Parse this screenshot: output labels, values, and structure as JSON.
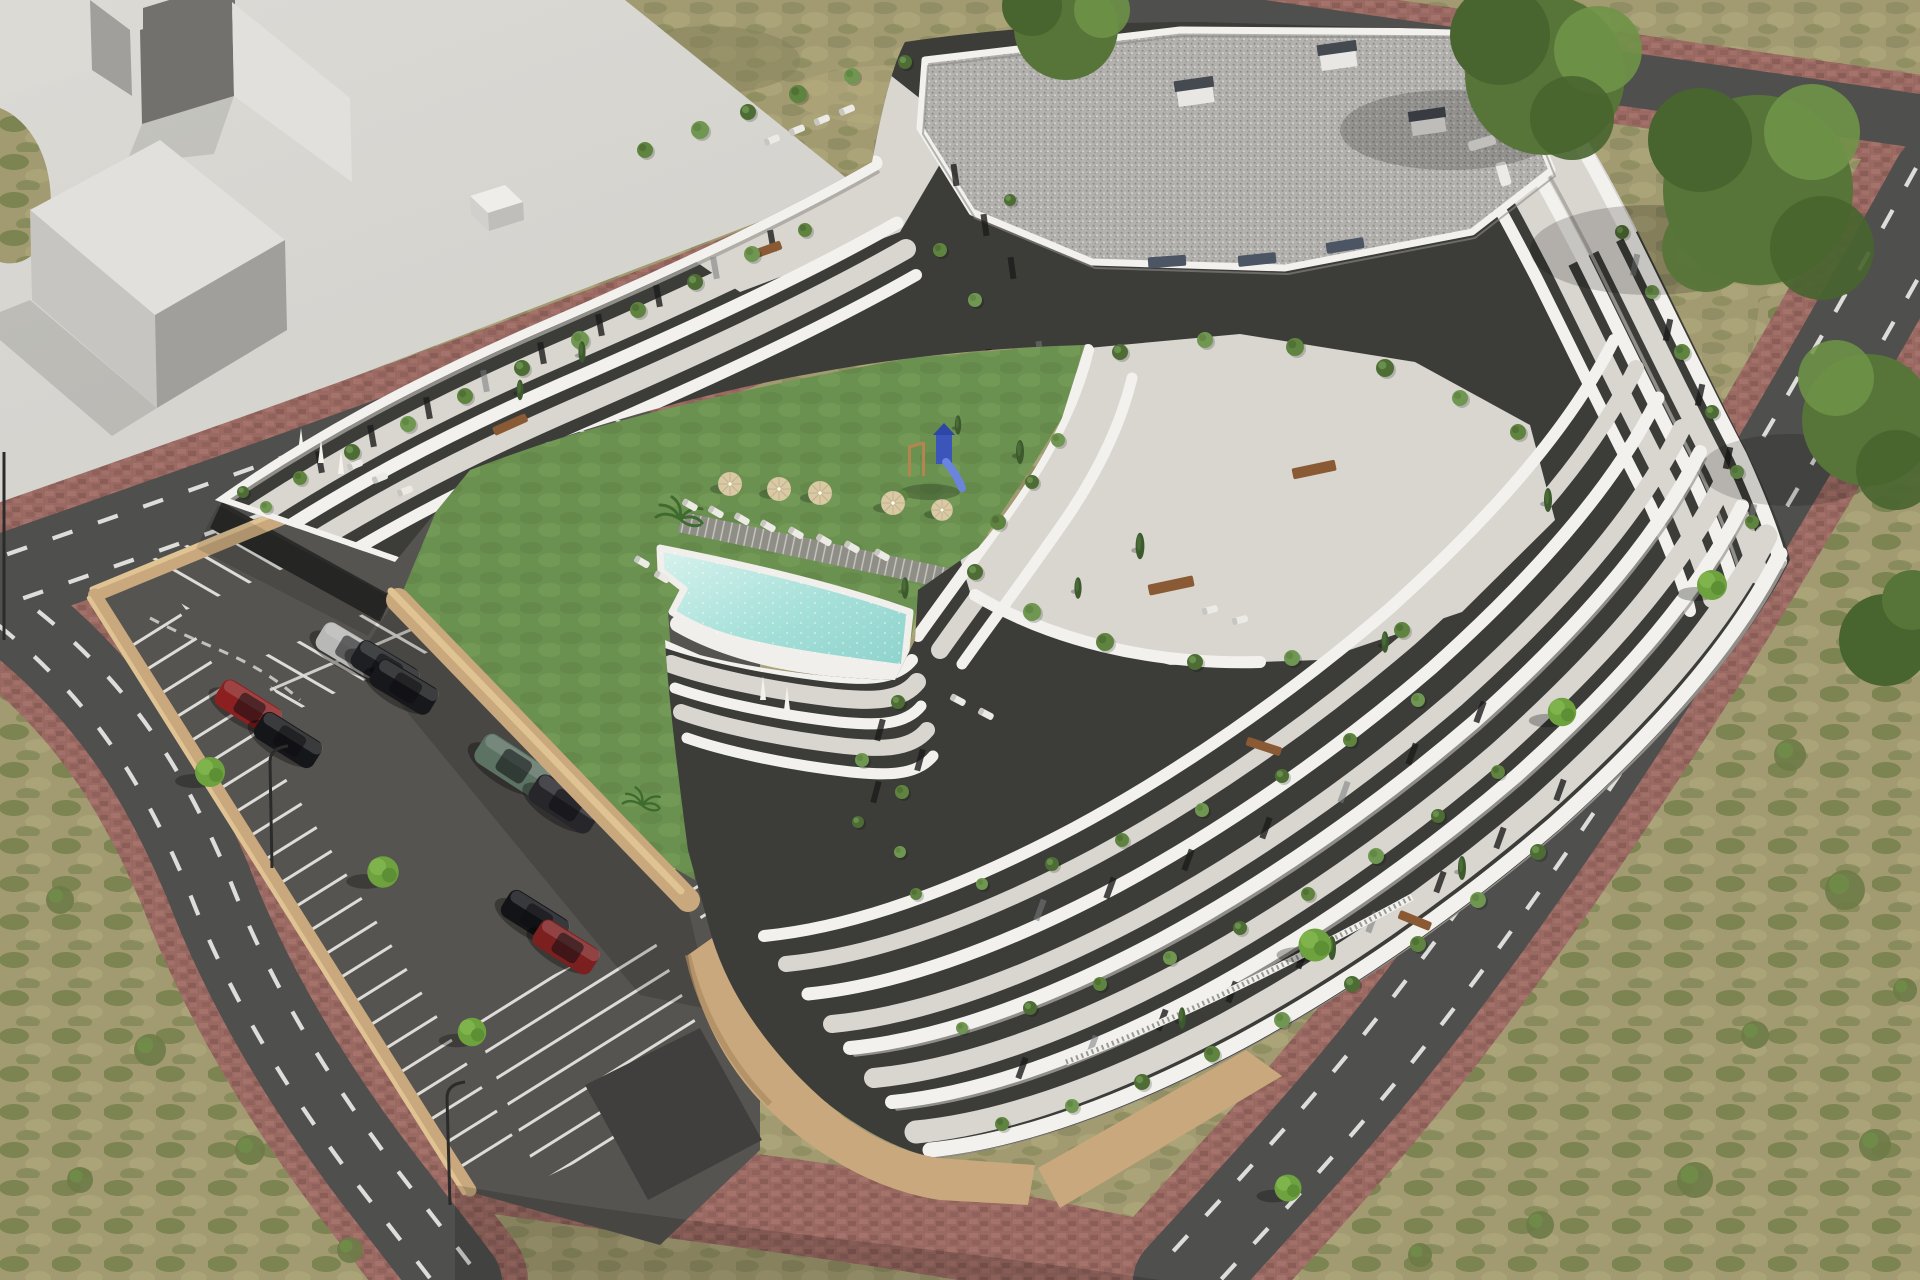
{
  "scene": {
    "type": "architectural-aerial-render",
    "description": "Aerial 3D rendering of a modern white terraced apartment complex with cascading balconies and roof gardens, a central courtyard with lawn, curved swimming pool, sun loungers, parasols and a blue playground, an open-air parking lot with parked cars, surrounded by streets with dashed lane markings, red paver sidewalks, street trees and dry scrubland, with a plain grey massing block of a neighbouring building in the upper left",
    "landmarks": {
      "building": "terraced-apartment-complex",
      "roof": "gravel-flat-roof-with-chimneys",
      "courtyard": "lawn-pool-playground",
      "parking": "surface-parking-lot",
      "streets": "perimeter-roads-with-red-paver-sidewalks",
      "background": "neighbouring-massing-block-and-dry-scrub"
    },
    "counts": {
      "parked_cars": 9,
      "parasols": 6,
      "street_trees": 7
    }
  },
  "palette": {
    "plaza": "#d3d1cc",
    "plaza_light": "#dcdad5",
    "block_light": "#e2e0dc",
    "block_mid": "#c7c5c1",
    "block_dark": "#a19f9b",
    "block_darkest": "#72716d",
    "dry_grass": "#a29a70",
    "dry_grass_dark": "#83825a",
    "dry_grass_light": "#b3aa7e",
    "scrub_green": "#6e7c48",
    "asphalt": "#4f4f4d",
    "asphalt_dark": "#403f3e",
    "road_line": "#e9e9e6",
    "paver": "#9a6a62",
    "paver_dark": "#865a53",
    "paver_light": "#a8766d",
    "wall_tan": "#c8a87c",
    "wall_tan_light": "#e0c393",
    "wall_tan_dark": "#ab8a5f",
    "parking_asphalt": "#565450",
    "stall_line": "#dddcd8",
    "lawn": "#6b9150",
    "lawn_dark": "#5d8245",
    "lawn_light": "#7aa25d",
    "pool_water": "#a5e0d9",
    "pool_water_light": "#d8f2ee",
    "pool_rim": "#f0efeb",
    "deck_plank": "#8e8e86",
    "deck_plank_gap": "#c9c9c3",
    "band_white": "#f2f1ed",
    "band_shade": "#a5a39e",
    "terrace_floor": "#d9d6d0",
    "charcoal": "#3c3c39",
    "charcoal_dark": "#2b2b29",
    "window_dark": "#1c1c1b",
    "glass_glint": "#767c7c",
    "gravel_base": "#b2b1ad",
    "gravel_dark": "#8b8a86",
    "gravel_light": "#d9d8d4",
    "chimney_top": "#454a51",
    "plant_green_a": "#4d6d35",
    "plant_green_b": "#5f8440",
    "plant_green_c": "#6f9752",
    "hedge_dark": "#46583a",
    "cypress": "#3c5a2e",
    "tree_green": "#577539",
    "tree_green_dark": "#48652f",
    "tree_green_light": "#6f9447",
    "street_tree": "#6da23f",
    "umbrella_tan": "#d9c9a4",
    "furniture_wood": "#8a5a34",
    "lounger_white": "#eceae5",
    "playground_blue": "#3b55bb",
    "playground_blue_dark": "#2e46a6",
    "car_silver": "#b8b8b6",
    "car_black": "#1d1f22",
    "car_red": "#8c2020",
    "car_red_dark": "#7c1f1f",
    "car_suv_green": "#5c7263",
    "shadow": "#000000"
  }
}
